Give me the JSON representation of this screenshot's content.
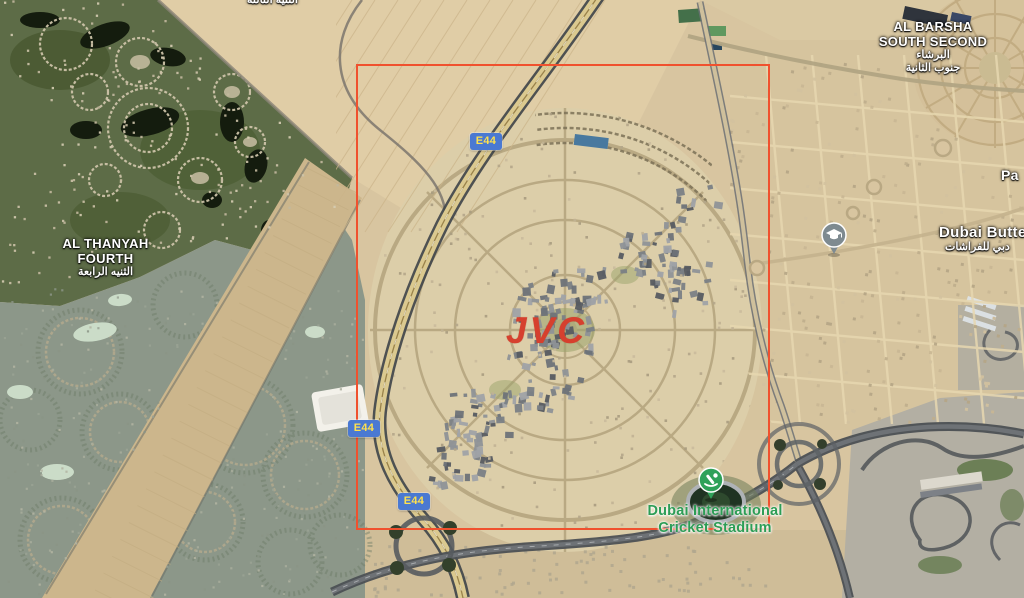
{
  "map": {
    "region_labels": {
      "al_barsha_south_second": {
        "en1": "AL BARSHA",
        "en2": "SOUTH SECOND",
        "ar1": "البرشاء",
        "ar2": "جنوب الثانية"
      },
      "al_thanyah_fourth": {
        "en1": "AL THANYAH",
        "en2": "FOURTH",
        "ar": "الثنيه الرابعة"
      },
      "top_edge_partial_ar": "الثنيه الثالثة",
      "right_edge_partial": "Pa",
      "dubai_butterfly_partial_en": "Dubai Butter",
      "dubai_butterfly_partial_ar": "دبي للفراشات"
    },
    "annotation": {
      "jvc_label": "JVC"
    },
    "pois": {
      "cricket_stadium": {
        "line1": "Dubai International",
        "line2": "Cricket Stadium"
      }
    },
    "road_badges": [
      {
        "label": "E44"
      },
      {
        "label": "E44"
      },
      {
        "label": "E44"
      }
    ],
    "colors": {
      "selection_rectangle": "#f0512e",
      "badge_bg": "#4a79d2",
      "badge_text": "#ffe14d",
      "jvc_text": "#d6402e",
      "poi_green": "#2d9d55"
    }
  }
}
